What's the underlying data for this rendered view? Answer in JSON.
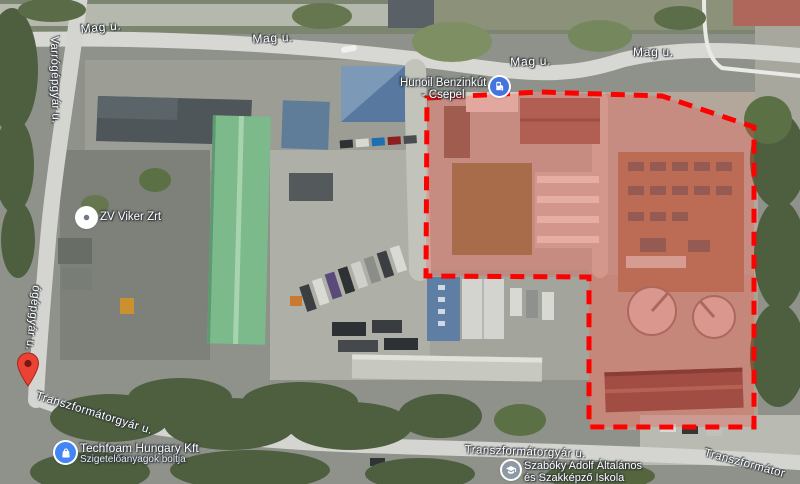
{
  "map": {
    "view": "satellite",
    "overlay": {
      "type": "dashed-selection-polygon",
      "stroke": "#ff0000",
      "fill_tint": "rgba(255,70,60,0.27)"
    },
    "street_labels": [
      {
        "id": "mag-u-1",
        "text": "Mag u."
      },
      {
        "id": "mag-u-2",
        "text": "Mag u."
      },
      {
        "id": "mag-u-3",
        "text": "Mag u."
      },
      {
        "id": "mag-u-4",
        "text": "Mag u."
      },
      {
        "id": "varrogepgyar-u",
        "text": "Varrógépgyár u."
      },
      {
        "id": "ogepgyar-u",
        "text": "ógépgyár u."
      },
      {
        "id": "transzformatorgyar-u-1",
        "text": "Transzformátorgyár u."
      },
      {
        "id": "transzformatorgyar-u-2",
        "text": "Transzformátorgyár u."
      },
      {
        "id": "transzformator-partial",
        "text": "Transzformátor"
      }
    ],
    "pois": [
      {
        "id": "hunoil",
        "line1": "Hunoil Benzinkút",
        "line2": "- Csepel",
        "icon": "fuel-pump-icon",
        "icon_color": "#4374e0"
      },
      {
        "id": "zv-viker",
        "name": "ZV Viker Zrt",
        "icon": "generic-poi-icon",
        "icon_color": "#ffffff"
      },
      {
        "id": "techfoam",
        "name": "Techfoam Hungary Kft",
        "subtitle": "Szigetelőanyagok boltja",
        "icon": "shopping-bag-icon",
        "icon_color": "#4285f4"
      },
      {
        "id": "szaboky",
        "line1": "Szabóky Adolf Általános",
        "line2": "és Szakképző Iskola",
        "icon": "school-icon",
        "icon_color": "#8d9aa5"
      }
    ],
    "marker": {
      "type": "red-map-pin",
      "color": "#ea4335"
    }
  }
}
